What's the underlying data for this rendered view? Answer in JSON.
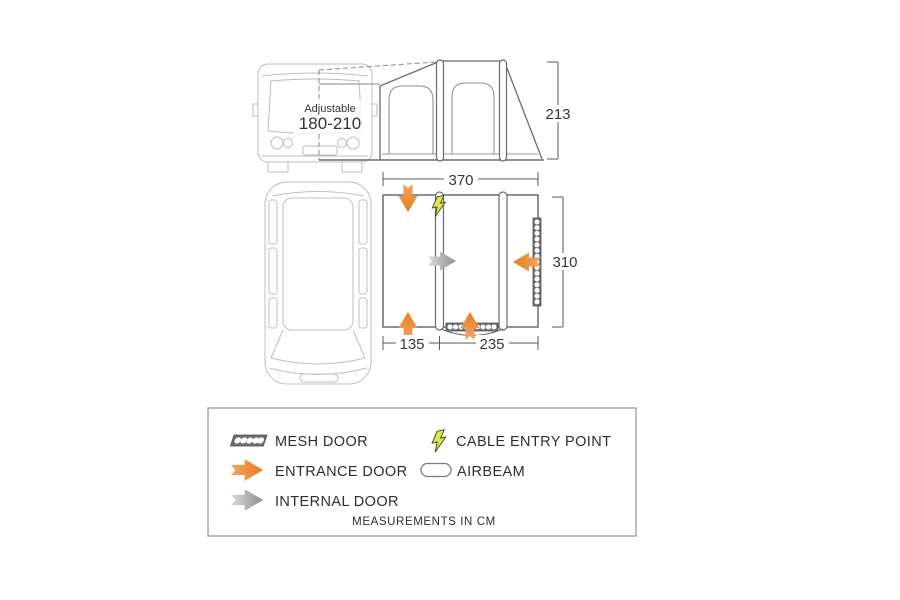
{
  "diagram": {
    "van_label": {
      "line1": "Adjustable",
      "line2": "180-210"
    },
    "dimensions": {
      "height": "213",
      "width": "370",
      "depth": "310",
      "left_section": "135",
      "right_section": "235"
    },
    "units": "cm"
  },
  "legend": {
    "mesh_door": "MESH DOOR",
    "cable_entry_point": "CABLE ENTRY POINT",
    "entrance_door": "ENTRANCE DOOR",
    "airbeam": "AIRBEAM",
    "internal_door": "INTERNAL DOOR",
    "note": "MEASUREMENTS IN CM"
  },
  "colors": {
    "entrance_door_arrow": "#E8811F",
    "internal_door_arrow": "#8F8F8F",
    "cable_entry_bolt": "#DFE551",
    "diagram_line": "#606060",
    "van_outline": "#BCBCBC"
  }
}
